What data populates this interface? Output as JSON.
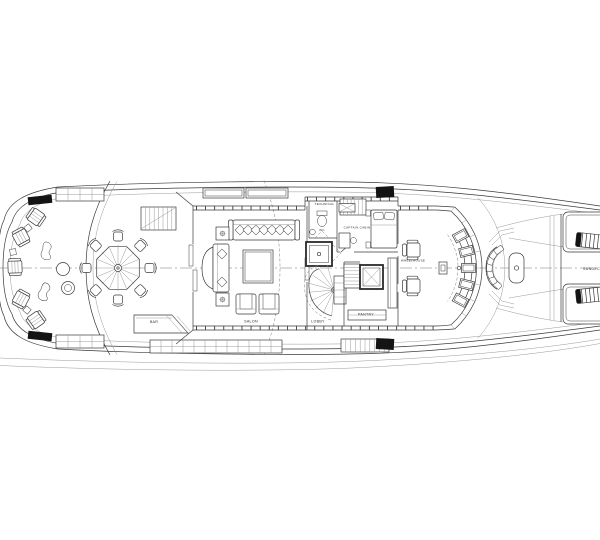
{
  "drawing": {
    "labels": {
      "technical": "TECHNICAL",
      "wc": "WC",
      "captain_cabin": "CAPTAIN CABIN",
      "wheelhouse": "WHEELHOUSE",
      "salon": "SALON",
      "lobby": "LOBBY",
      "pantry": "PANTRY",
      "bar": "BAR",
      "sundeck": "SUNDECK"
    },
    "colors": {
      "background": "#ffffff",
      "line": "#3a3a3a",
      "dark_fill": "#141414",
      "centerline": "#777777"
    }
  }
}
